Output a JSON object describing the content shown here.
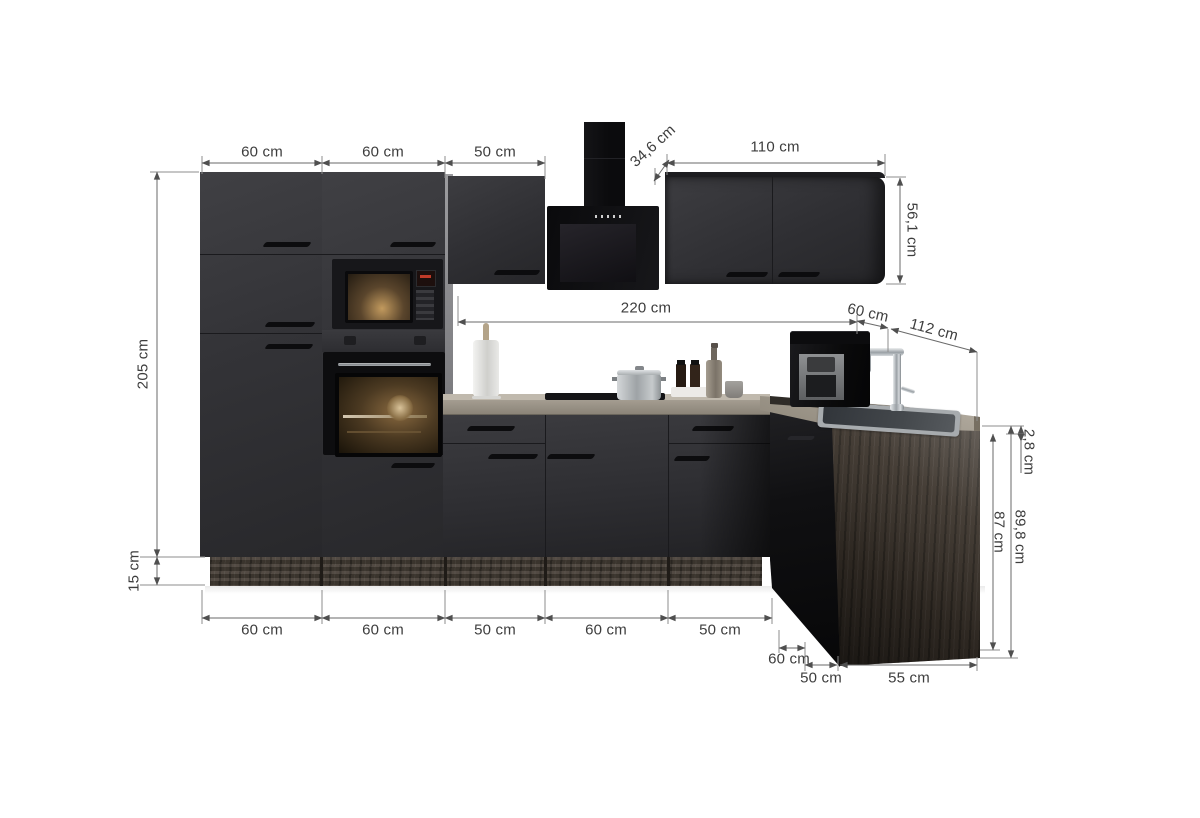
{
  "image_type": "kitchen corner unit dimension diagram",
  "colors": {
    "background": "#ffffff",
    "cabinet_front": "#333337",
    "appliance_black": "#0d0d0f",
    "worktop": "#b5aea2",
    "plinth_wood": "#473f37",
    "side_panel_wood": "#3c342c",
    "steel": "#a7abae",
    "annotation_line": "#757575",
    "annotation_text": "#3d3d3d"
  },
  "labels": {
    "tall_unit_1_width": "60 cm",
    "tall_unit_2_width": "60 cm",
    "wall_cabinet_width": "50 cm",
    "wall_depth": "34,6 cm",
    "corner_wall_cabinet_width": "110 cm",
    "wall_cabinet_height": "56,1 cm",
    "left_run_length": "220 cm",
    "corner_width_top": "60 cm",
    "right_run_length": "112 cm",
    "worktop_thickness": "2,8 cm",
    "base_cabinet_height": "87 cm",
    "total_base_height": "89,8 cm",
    "tall_unit_height": "205 cm",
    "plinth_height": "15 cm",
    "base_1_width": "60 cm",
    "base_2_width": "60 cm",
    "base_3_width": "50 cm",
    "base_4_width": "60 cm",
    "base_5_width": "50 cm",
    "corner_width_bottom": "60 cm",
    "right_base_1_width": "50 cm",
    "right_base_2_width": "55 cm"
  }
}
